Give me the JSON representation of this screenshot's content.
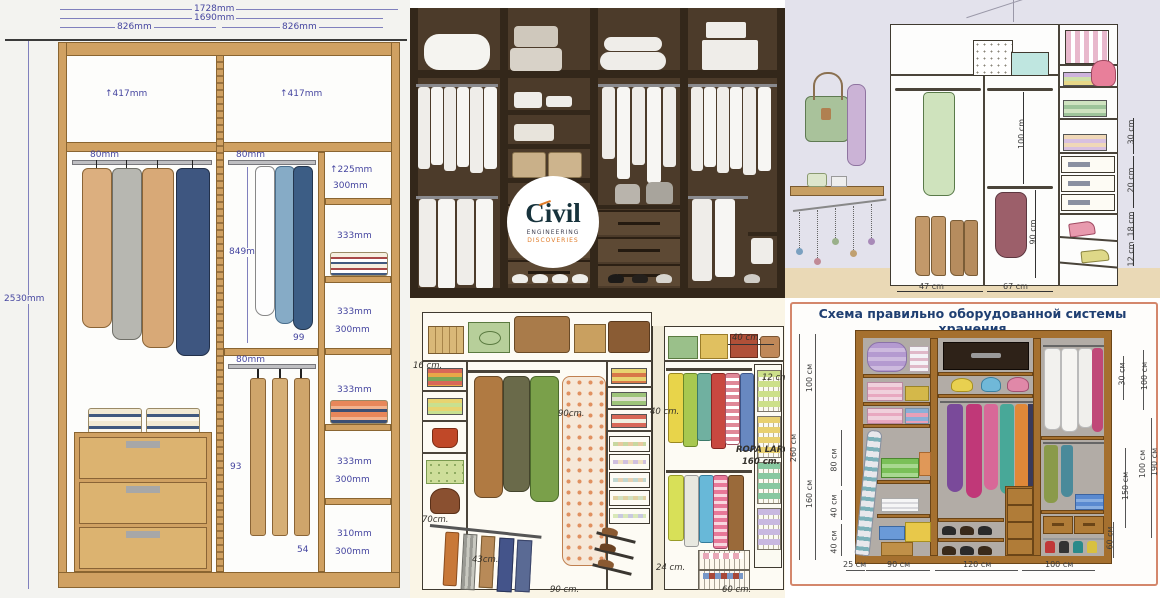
{
  "palette": {
    "blueprint_dim_text": "#4646a0",
    "blueprint_wood": "#d0a162",
    "render_wood": "#4c3b2a",
    "logo_teal": "#17333c",
    "logo_orange": "#e07b28",
    "sketch_bg": "#e3e2ec",
    "scheme_border": "#d4876c",
    "scheme_title_color": "#1f3f72"
  },
  "blueprint": {
    "width_total": "1728mm",
    "width_inner": "1690mm",
    "width_left": "826mm",
    "width_right": "826mm",
    "height_total": "2530mm",
    "top_left_comp": "↑417mm",
    "top_right_comp": "↑417mm",
    "rail_top_left": "80mm",
    "rail_top_mid": "80mm",
    "rail_low_mid": "80mm",
    "hang_height": "849mm",
    "num_99": "99",
    "num_93": "93",
    "num_54": "54",
    "shelf_labels": {
      "s1": "↑225mm",
      "s2": "300mm",
      "s3": "333mm",
      "s4": "333mm",
      "s5": "300mm",
      "s6": "333mm",
      "s7": "333mm",
      "s8": "300mm",
      "s9": "310mm",
      "s10": "300mm"
    }
  },
  "render_logo": {
    "brand": "Civil",
    "line1": "ENGINEERING",
    "line2": "DISCOVERIES"
  },
  "sketch": {
    "hang_upper": "100 cm",
    "hang_lower": "90 cm",
    "width_left": "47 cm",
    "width_right": "67 cm",
    "shelf_30": "30 cm",
    "drawer_20": "20 cm",
    "shoe_18": "18 cm",
    "shoe_12": "12 cm"
  },
  "walkin": {
    "d16": "16 cm.",
    "d40_top": "40 cm.",
    "d12": "12 cm.",
    "d90_mid": "90cm.",
    "d40_mid": "40 cm.",
    "d70": "70cm.",
    "d43": "43cm.",
    "d90_bottom": "90 cm.",
    "d24": "24 cm.",
    "d60": "60 cm.",
    "ropa_label": "ROPA LARGA",
    "ropa_height": "160 cm."
  },
  "scheme": {
    "title": "Схема правильно оборудованной системы хранения",
    "left": {
      "h100": "100 см",
      "h260": "260 см",
      "h160": "160 см",
      "h80": "80 см",
      "h40a": "40 см",
      "h40b": "40 см"
    },
    "bottom": {
      "w25": "25 см",
      "w90": "90 см",
      "w120": "120 см",
      "w100": "100 см"
    },
    "right": {
      "h30": "30 см",
      "h100a": "100 см",
      "h150": "150 см",
      "h100b": "100 см",
      "h190": "190 см",
      "h60": "60 см"
    }
  }
}
